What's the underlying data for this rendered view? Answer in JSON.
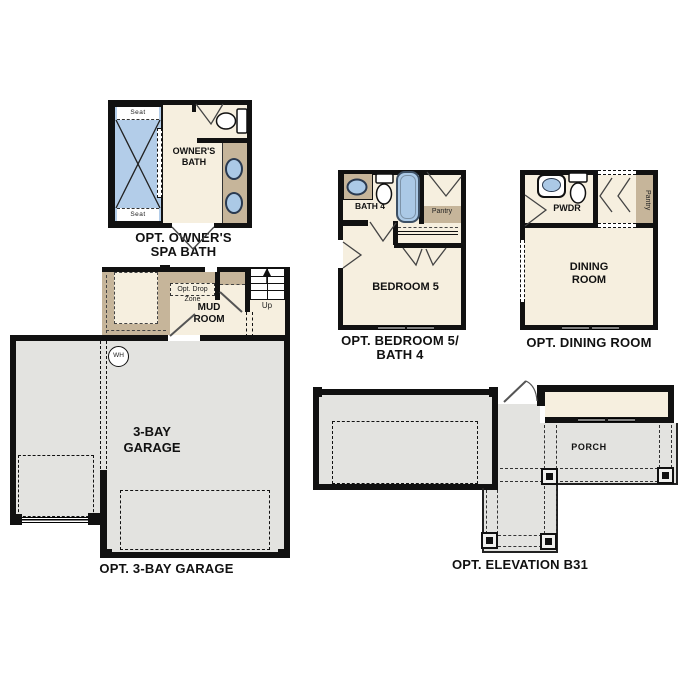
{
  "colors": {
    "wall": "#111111",
    "interior_cream": "#f6efdf",
    "accent_tan": "#c6b59a",
    "fixture_blue": "#abc9e6",
    "garage_gray": "#e3e3e0",
    "text": "#111111"
  },
  "sections": {
    "owners_spa_bath": {
      "caption_line1": "OPT. OWNER'S",
      "caption_line2": "SPA BATH",
      "room_line1": "OWNER'S",
      "room_line2": "BATH",
      "seat_label": "Seat"
    },
    "bedroom5_bath4": {
      "caption_line1": "OPT. BEDROOM 5/",
      "caption_line2": "BATH 4",
      "bath_label": "BATH 4",
      "pantry_label": "Pantry",
      "bedroom_label": "BEDROOM 5"
    },
    "dining_room": {
      "caption": "OPT. DINING ROOM",
      "powder_label": "PWDR",
      "pantry_label": "Pantry",
      "room_line1": "DINING",
      "room_line2": "ROOM"
    },
    "garage": {
      "caption": "OPT. 3-BAY GARAGE",
      "drop_zone_line1": "Opt. Drop",
      "drop_zone_line2": "Zone",
      "mud_room_line1": "MUD",
      "mud_room_line2": "ROOM",
      "stairs_label": "Up",
      "water_heater_label": "WH",
      "room_line1": "3-BAY",
      "room_line2": "GARAGE"
    },
    "elevation_b31": {
      "caption": "OPT. ELEVATION B31",
      "porch_label": "PORCH"
    }
  }
}
